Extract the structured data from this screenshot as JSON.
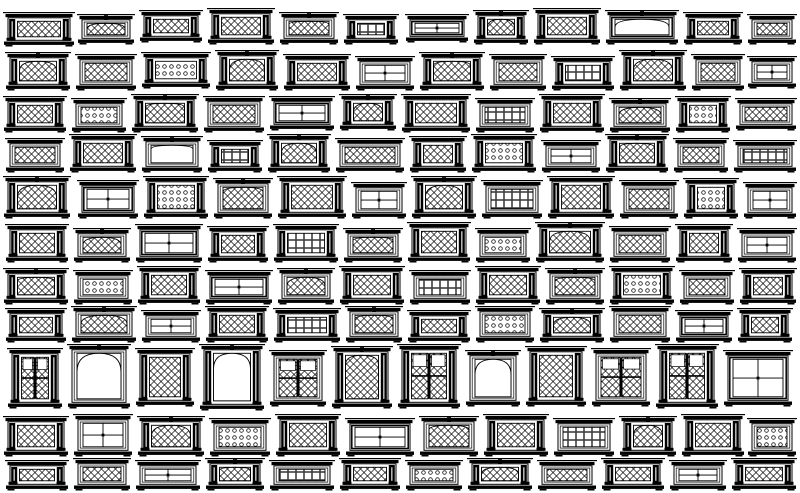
{
  "meta": {
    "description": "cad-window-blocks-library-sheet",
    "width": 800,
    "height": 493,
    "background": "#ffffff",
    "ink": "#000000"
  },
  "block_format": [
    "x",
    "w",
    "h",
    "glazing",
    "frame",
    "arch",
    "dy"
  ],
  "glazing_codes": {
    "L": "diamond-lattice",
    "D": "dot-grid",
    "G": "square-grid",
    "B": "plain-panes",
    "O": "double-door-leaves"
  },
  "frame_codes": {
    "p": "side-pilasters",
    "n": "plain",
    "h": "heavy-border"
  },
  "arch_codes": {
    "n": "flat-top",
    "r": "round-arch",
    "s": "segmental-arch"
  },
  "rows": [
    {
      "y": 8,
      "blocks": [
        [
          8,
          62,
          34,
          "L",
          "p",
          "n",
          4
        ],
        [
          82,
          48,
          30,
          "L",
          "n",
          "r",
          6
        ],
        [
          144,
          54,
          32,
          "L",
          "p",
          "n",
          2
        ],
        [
          212,
          58,
          36,
          "L",
          "p",
          "n",
          0
        ],
        [
          284,
          50,
          32,
          "L",
          "n",
          "s",
          4
        ],
        [
          348,
          46,
          30,
          "G",
          "p",
          "n",
          6
        ],
        [
          410,
          54,
          28,
          "B",
          "h",
          "n",
          6
        ],
        [
          478,
          46,
          34,
          "L",
          "p",
          "r",
          2
        ],
        [
          538,
          58,
          36,
          "L",
          "p",
          "n",
          0
        ],
        [
          610,
          64,
          34,
          "B",
          "h",
          "r",
          2
        ],
        [
          688,
          50,
          32,
          "L",
          "p",
          "n",
          4
        ],
        [
          752,
          40,
          30,
          "L",
          "n",
          "n",
          6
        ]
      ]
    },
    {
      "y": 50,
      "blocks": [
        [
          10,
          56,
          38,
          "L",
          "p",
          "r",
          2
        ],
        [
          80,
          52,
          36,
          "L",
          "n",
          "n",
          4
        ],
        [
          146,
          60,
          36,
          "D",
          "p",
          "n",
          2
        ],
        [
          220,
          54,
          40,
          "L",
          "p",
          "r",
          0
        ],
        [
          288,
          58,
          36,
          "L",
          "p",
          "n",
          4
        ],
        [
          360,
          50,
          34,
          "B",
          "n",
          "n",
          6
        ],
        [
          424,
          56,
          38,
          "L",
          "p",
          "s",
          2
        ],
        [
          494,
          48,
          36,
          "L",
          "n",
          "n",
          4
        ],
        [
          556,
          54,
          34,
          "G",
          "p",
          "n",
          6
        ],
        [
          624,
          58,
          40,
          "L",
          "p",
          "r",
          0
        ],
        [
          696,
          44,
          36,
          "L",
          "n",
          "n",
          4
        ],
        [
          752,
          40,
          32,
          "B",
          "n",
          "n",
          6
        ]
      ]
    },
    {
      "y": 92,
      "blocks": [
        [
          8,
          54,
          36,
          "L",
          "p",
          "n",
          4
        ],
        [
          76,
          46,
          34,
          "D",
          "n",
          "n",
          6
        ],
        [
          136,
          58,
          38,
          "L",
          "p",
          "s",
          2
        ],
        [
          208,
          52,
          36,
          "L",
          "n",
          "n",
          4
        ],
        [
          274,
          56,
          34,
          "B",
          "h",
          "n",
          4
        ],
        [
          344,
          48,
          36,
          "L",
          "p",
          "r",
          2
        ],
        [
          406,
          60,
          38,
          "L",
          "p",
          "n",
          2
        ],
        [
          480,
          50,
          34,
          "G",
          "n",
          "n",
          6
        ],
        [
          544,
          56,
          38,
          "L",
          "p",
          "n",
          2
        ],
        [
          614,
          52,
          34,
          "L",
          "n",
          "r",
          6
        ],
        [
          680,
          46,
          36,
          "D",
          "p",
          "n",
          4
        ],
        [
          740,
          52,
          32,
          "L",
          "n",
          "n",
          6
        ]
      ]
    },
    {
      "y": 134,
      "blocks": [
        [
          10,
          50,
          34,
          "L",
          "n",
          "n",
          4
        ],
        [
          74,
          58,
          38,
          "L",
          "p",
          "n",
          0
        ],
        [
          146,
          52,
          36,
          "B",
          "n",
          "s",
          2
        ],
        [
          212,
          46,
          32,
          "G",
          "p",
          "n",
          6
        ],
        [
          272,
          54,
          38,
          "L",
          "p",
          "r",
          0
        ],
        [
          340,
          60,
          34,
          "L",
          "n",
          "n",
          4
        ],
        [
          414,
          48,
          36,
          "L",
          "p",
          "n",
          2
        ],
        [
          476,
          56,
          38,
          "D",
          "p",
          "n",
          0
        ],
        [
          546,
          50,
          32,
          "B",
          "n",
          "n",
          6
        ],
        [
          610,
          54,
          38,
          "L",
          "p",
          "s",
          0
        ],
        [
          678,
          46,
          34,
          "L",
          "n",
          "n",
          4
        ],
        [
          738,
          54,
          32,
          "G",
          "n",
          "n",
          6
        ]
      ]
    },
    {
      "y": 176,
      "blocks": [
        [
          8,
          58,
          42,
          "L",
          "p",
          "r",
          0
        ],
        [
          82,
          52,
          38,
          "B",
          "h",
          "n",
          4
        ],
        [
          148,
          56,
          42,
          "D",
          "p",
          "n",
          0
        ],
        [
          218,
          50,
          40,
          "L",
          "n",
          "s",
          2
        ],
        [
          282,
          60,
          42,
          "L",
          "p",
          "n",
          0
        ],
        [
          356,
          46,
          36,
          "B",
          "n",
          "n",
          6
        ],
        [
          416,
          56,
          42,
          "L",
          "p",
          "r",
          0
        ],
        [
          486,
          52,
          38,
          "G",
          "n",
          "n",
          4
        ],
        [
          552,
          58,
          42,
          "L",
          "p",
          "n",
          0
        ],
        [
          624,
          50,
          38,
          "L",
          "n",
          "n",
          4
        ],
        [
          688,
          46,
          40,
          "D",
          "p",
          "n",
          2
        ],
        [
          748,
          44,
          36,
          "B",
          "n",
          "n",
          6
        ]
      ]
    },
    {
      "y": 222,
      "blocks": [
        [
          10,
          54,
          38,
          "L",
          "p",
          "n",
          2
        ],
        [
          78,
          48,
          34,
          "L",
          "n",
          "r",
          6
        ],
        [
          140,
          58,
          38,
          "B",
          "h",
          "n",
          2
        ],
        [
          212,
          52,
          36,
          "L",
          "p",
          "n",
          4
        ],
        [
          278,
          56,
          38,
          "G",
          "p",
          "n",
          2
        ],
        [
          348,
          50,
          34,
          "L",
          "n",
          "s",
          6
        ],
        [
          412,
          54,
          40,
          "L",
          "p",
          "n",
          0
        ],
        [
          480,
          46,
          34,
          "D",
          "n",
          "n",
          6
        ],
        [
          540,
          60,
          40,
          "L",
          "p",
          "r",
          0
        ],
        [
          614,
          52,
          36,
          "L",
          "n",
          "n",
          4
        ],
        [
          680,
          48,
          38,
          "L",
          "p",
          "n",
          2
        ],
        [
          742,
          50,
          34,
          "B",
          "n",
          "n",
          6
        ]
      ]
    },
    {
      "y": 266,
      "blocks": [
        [
          8,
          56,
          36,
          "L",
          "p",
          "s",
          2
        ],
        [
          78,
          50,
          34,
          "D",
          "n",
          "n",
          4
        ],
        [
          142,
          54,
          38,
          "L",
          "p",
          "n",
          0
        ],
        [
          210,
          58,
          34,
          "B",
          "h",
          "n",
          4
        ],
        [
          282,
          48,
          36,
          "L",
          "n",
          "r",
          2
        ],
        [
          344,
          56,
          38,
          "L",
          "p",
          "n",
          0
        ],
        [
          414,
          52,
          34,
          "G",
          "n",
          "n",
          4
        ],
        [
          480,
          56,
          38,
          "L",
          "p",
          "n",
          0
        ],
        [
          550,
          50,
          36,
          "L",
          "n",
          "s",
          2
        ],
        [
          614,
          56,
          38,
          "D",
          "p",
          "n",
          0
        ],
        [
          684,
          46,
          34,
          "L",
          "n",
          "n",
          4
        ],
        [
          744,
          48,
          36,
          "L",
          "p",
          "n",
          2
        ]
      ]
    },
    {
      "y": 306,
      "blocks": [
        [
          10,
          52,
          34,
          "L",
          "p",
          "n",
          2
        ],
        [
          76,
          56,
          36,
          "L",
          "n",
          "r",
          0
        ],
        [
          146,
          50,
          32,
          "B",
          "n",
          "n",
          4
        ],
        [
          210,
          54,
          36,
          "L",
          "p",
          "n",
          0
        ],
        [
          278,
          58,
          34,
          "G",
          "p",
          "n",
          2
        ],
        [
          350,
          48,
          36,
          "L",
          "n",
          "s",
          0
        ],
        [
          412,
          54,
          32,
          "L",
          "p",
          "n",
          4
        ],
        [
          480,
          50,
          36,
          "D",
          "n",
          "n",
          0
        ],
        [
          544,
          56,
          34,
          "L",
          "p",
          "r",
          2
        ],
        [
          614,
          52,
          36,
          "L",
          "n",
          "n",
          0
        ],
        [
          680,
          48,
          32,
          "B",
          "h",
          "n",
          4
        ],
        [
          742,
          46,
          34,
          "L",
          "p",
          "n",
          2
        ]
      ]
    },
    {
      "y": 344,
      "blocks": [
        [
          12,
          46,
          60,
          "O",
          "p",
          "n",
          4
        ],
        [
          72,
          54,
          64,
          "O",
          "n",
          "r",
          0
        ],
        [
          140,
          50,
          58,
          "L",
          "p",
          "n",
          4
        ],
        [
          204,
          56,
          66,
          "O",
          "p",
          "r",
          0
        ],
        [
          274,
          48,
          56,
          "O",
          "n",
          "n",
          6
        ],
        [
          336,
          52,
          62,
          "L",
          "p",
          "s",
          2
        ],
        [
          402,
          54,
          64,
          "O",
          "p",
          "n",
          0
        ],
        [
          470,
          46,
          56,
          "O",
          "n",
          "r",
          6
        ],
        [
          530,
          52,
          60,
          "L",
          "p",
          "n",
          2
        ],
        [
          596,
          50,
          58,
          "O",
          "n",
          "n",
          4
        ],
        [
          660,
          54,
          64,
          "O",
          "p",
          "n",
          0
        ],
        [
          728,
          60,
          56,
          "B",
          "h",
          "n",
          6
        ]
      ]
    },
    {
      "y": 414,
      "blocks": [
        [
          8,
          56,
          40,
          "L",
          "p",
          "n",
          2
        ],
        [
          78,
          50,
          42,
          "B",
          "n",
          "n",
          0
        ],
        [
          142,
          58,
          40,
          "L",
          "p",
          "r",
          2
        ],
        [
          214,
          52,
          38,
          "D",
          "n",
          "n",
          4
        ],
        [
          280,
          56,
          42,
          "L",
          "p",
          "n",
          0
        ],
        [
          350,
          60,
          38,
          "B",
          "h",
          "n",
          4
        ],
        [
          424,
          50,
          40,
          "L",
          "n",
          "s",
          2
        ],
        [
          488,
          56,
          42,
          "L",
          "p",
          "n",
          0
        ],
        [
          558,
          52,
          38,
          "G",
          "n",
          "n",
          4
        ],
        [
          624,
          48,
          40,
          "L",
          "p",
          "r",
          2
        ],
        [
          686,
          54,
          42,
          "L",
          "p",
          "n",
          0
        ],
        [
          752,
          40,
          38,
          "D",
          "n",
          "n",
          4
        ]
      ]
    },
    {
      "y": 458,
      "blocks": [
        [
          10,
          54,
          30,
          "L",
          "p",
          "n",
          2
        ],
        [
          78,
          48,
          32,
          "L",
          "n",
          "n",
          0
        ],
        [
          140,
          56,
          30,
          "B",
          "n",
          "n",
          2
        ],
        [
          210,
          50,
          32,
          "L",
          "p",
          "s",
          0
        ],
        [
          274,
          56,
          30,
          "G",
          "n",
          "n",
          2
        ],
        [
          344,
          52,
          32,
          "L",
          "p",
          "n",
          0
        ],
        [
          410,
          48,
          30,
          "D",
          "n",
          "n",
          2
        ],
        [
          472,
          56,
          32,
          "L",
          "p",
          "r",
          0
        ],
        [
          542,
          50,
          30,
          "L",
          "n",
          "n",
          2
        ],
        [
          606,
          54,
          32,
          "L",
          "p",
          "n",
          0
        ],
        [
          674,
          48,
          30,
          "B",
          "n",
          "n",
          2
        ],
        [
          736,
          56,
          32,
          "L",
          "p",
          "n",
          0
        ]
      ]
    }
  ]
}
